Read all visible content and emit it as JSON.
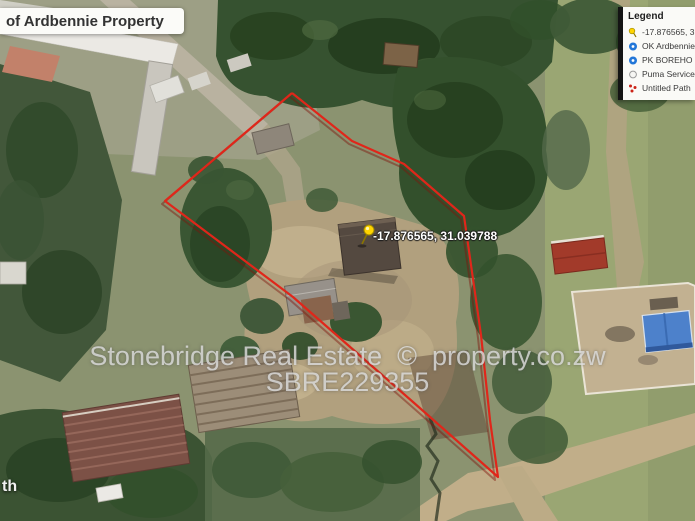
{
  "header": {
    "title": "of Ardbennie Property"
  },
  "legend": {
    "header": "Legend",
    "items": [
      {
        "icon": "pushpin-icon",
        "label": "-17.876565, 3"
      },
      {
        "icon": "placemark-icon",
        "label": "OK Ardbennie"
      },
      {
        "icon": "placemark-icon",
        "label": "PK BOREHO"
      },
      {
        "icon": "circle-outline-icon",
        "label": "Puma Service"
      },
      {
        "icon": "path-icon",
        "label": "Untitled Path"
      }
    ]
  },
  "map": {
    "pin_label": "-17.876565, 31.039788",
    "street_label_partial": "th"
  },
  "watermark": {
    "line1": "Stonebridge Real Estate  ©  property.co.zw",
    "line2": "SBRE229355"
  },
  "colors": {
    "boundary_red": "#e0261a",
    "boundary_shadow": "#7e150a",
    "pin_yellow": "#ffd400",
    "placemark_blue": "#2276d8",
    "path_red": "#cc2418",
    "outline_gray": "#9a9a9a"
  }
}
